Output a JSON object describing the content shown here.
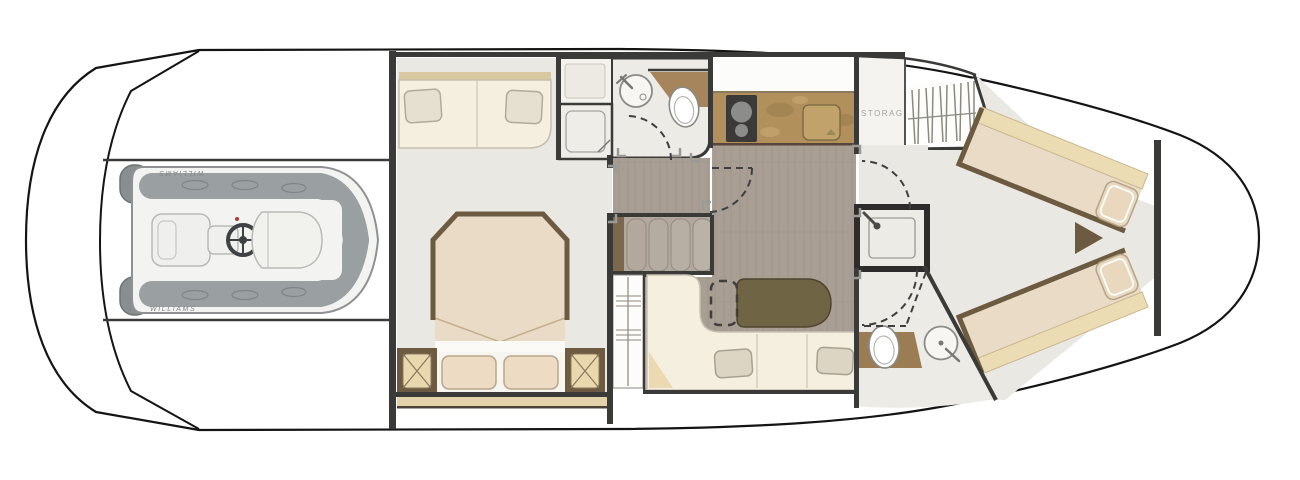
{
  "plan": {
    "labels": {
      "storage": "STORAGE",
      "tender_brand": "WILLIAMS",
      "tender_brand_mirrored": "WILLIAMS"
    },
    "colors": {
      "hull_stroke": "#141414",
      "wall_dark": "#3a3a38",
      "marble_floor": "#eae8e2",
      "bath_floor": "#edebe6",
      "wood_floor": "#a89e93",
      "granite_counter": "#b2905c",
      "vanity_brown": "#9c7c52",
      "toilet_counter": "#a6855c",
      "bed_mattress": "#e9dbc6",
      "blanket_cream": "#ecdcb4",
      "sofa_cream": "#f5efe0",
      "pillow_beige": "#e6e0d0",
      "table_olive": "#6f6444",
      "stool_tan": "#e9d7ae",
      "frame_brown": "#6d5b41",
      "shelf_tan": "#e2d1a9",
      "stairs_tread": "#b2a89d",
      "stairs_edge": "#7c694d",
      "tender_pad": "#9aa0a2",
      "tender_dark": "#898f91",
      "tender_hull": "#f3f3f1",
      "cooktop_dark": "#3b3a38"
    },
    "areas": [
      "tender-garage",
      "mid-cabin",
      "mid-bathroom",
      "companionway-stairs",
      "wardrobe",
      "salon-dinette",
      "galley",
      "storage-room",
      "hanging-locker",
      "forward-cabin",
      "forward-bathroom"
    ]
  }
}
